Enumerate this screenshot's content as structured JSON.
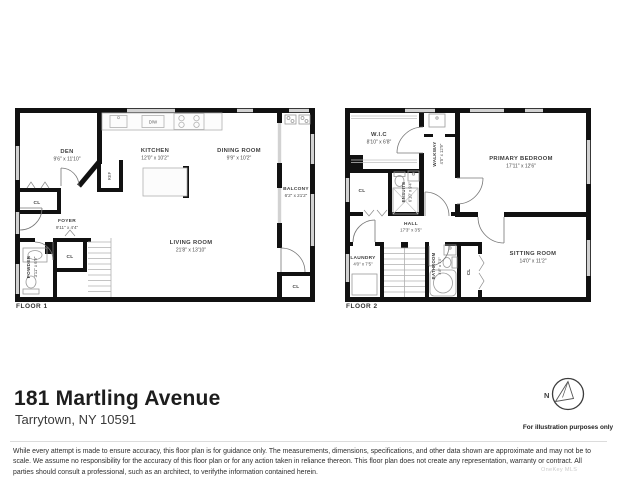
{
  "address": {
    "line1": "181 Martling Avenue",
    "line2": "Tarrytown, NY 10591"
  },
  "compass": {
    "letter": "N",
    "caption": "For illustration purposes only"
  },
  "disclaimer": "While every attempt is made to ensure accuracy, this floor plan is for guidance only. The measurements, dimensions, specifications, and other data shown are approximate and may not be to scale.  We assume no responsibility for the accuracy of this floor plan or for any action taken in reliance thereon. This floor plan does not create any representation, warranty or contract. All parties should consult a professional, such as an architect, to verifythe information contained herein.",
  "watermark": "OneKey MLS",
  "colors": {
    "wall": "#111111",
    "window": "#d2d2d2",
    "fixture": "#9a9a9a",
    "label_text": "#3d3d3d"
  },
  "floor1": {
    "label": "FLOOR 1",
    "rooms": {
      "den": {
        "name": "DEN",
        "dims": "9'6\" x 11'10\""
      },
      "kitchen": {
        "name": "KITCHEN",
        "dims": "12'0\" x 10'2\""
      },
      "dining": {
        "name": "DINING ROOM",
        "dims": "9'9\" x 10'2\""
      },
      "balcony": {
        "name": "BALCONY",
        "dims": "6'2\" x 21'2\""
      },
      "living": {
        "name": "LIVING ROOM",
        "dims": "21'8\" x 13'10\""
      },
      "foyer": {
        "name": "FOYER",
        "dims": "9'11\" x 4'4\""
      },
      "powder": {
        "name": "POWDER",
        "dims": "3'11\" x 6'9\""
      }
    },
    "closets": [
      "CL",
      "CL",
      "CL"
    ],
    "fixtures": {
      "ref": "REF",
      "dw": "D/W"
    }
  },
  "floor2": {
    "label": "FLOOR 2",
    "rooms": {
      "wic": {
        "name": "W.I.C",
        "dims": "8'10\" x 6'8\""
      },
      "walkway": {
        "name": "WALKWAY",
        "dims": "4'5\" x 12'9\""
      },
      "primary": {
        "name": "PRIMARY BEDROOM",
        "dims": "17'11\" x 12'6\""
      },
      "ensuite": {
        "name": "ENSUITE",
        "dims": "6'10\" x 9'4\""
      },
      "hall": {
        "name": "HALL",
        "dims": "17'3\" x 3'5\""
      },
      "laundry": {
        "name": "LAUNDRY",
        "dims": "4'0\" x 7'5\""
      },
      "bathroom": {
        "name": "BATHROOM",
        "dims": "4'8\" x 7'5\""
      },
      "sitting": {
        "name": "SITTING ROOM",
        "dims": "14'0\" x 11'2\""
      }
    },
    "closets": [
      "CL",
      "CL"
    ]
  }
}
